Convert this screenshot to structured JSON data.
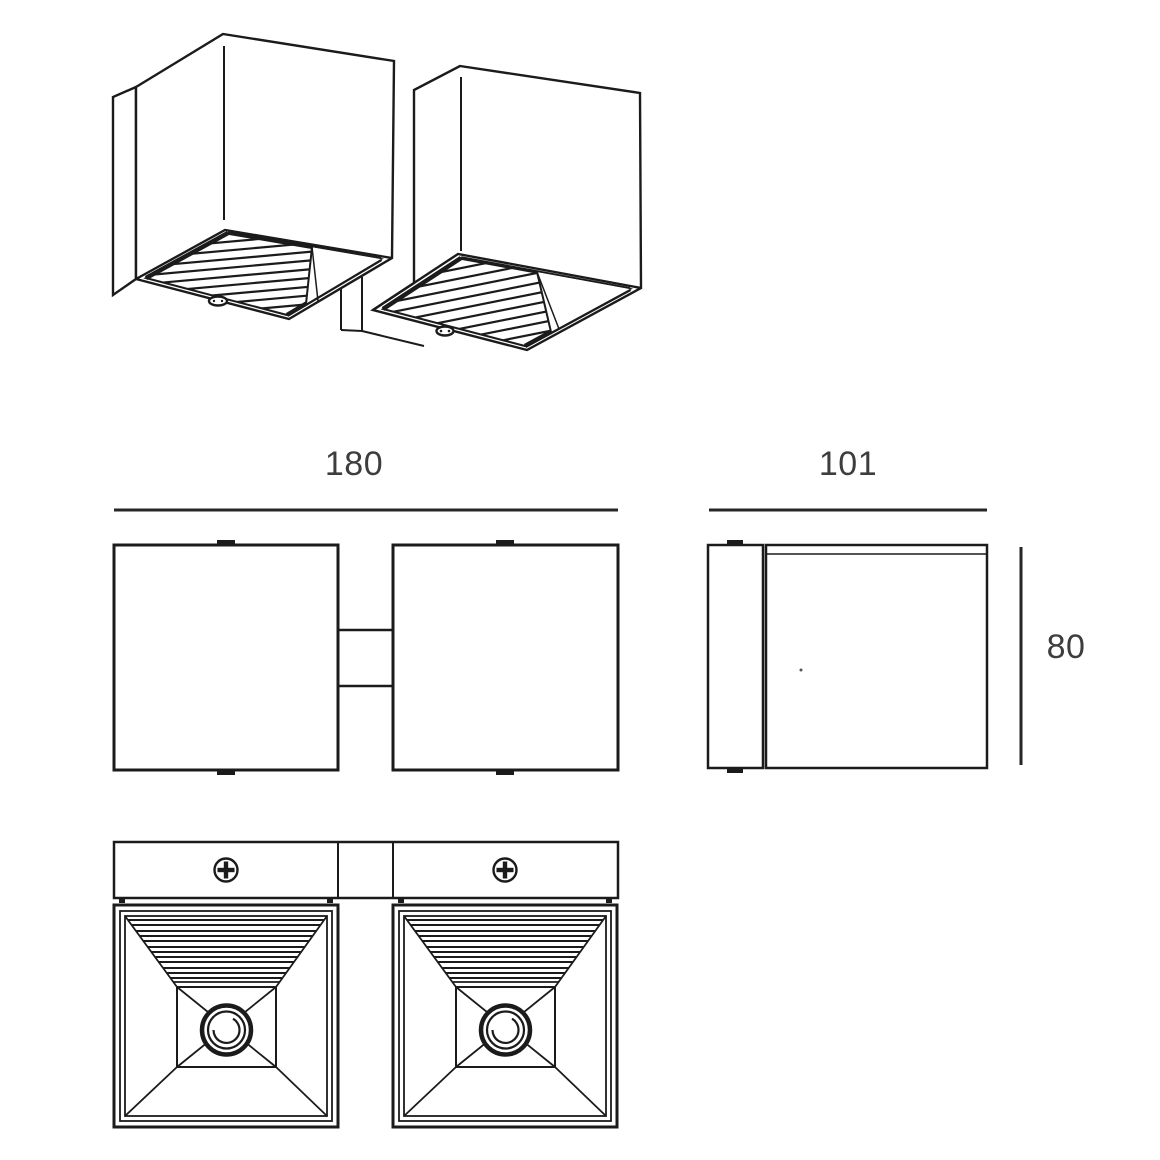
{
  "colors": {
    "background": "#ffffff",
    "line": "#1b1b1b",
    "dimension_text": "#3d3d3d"
  },
  "dimension_labels": {
    "total_width": "180",
    "depth": "101",
    "height": "80"
  },
  "bottom_view": {
    "screw_icon": "phillips-screw",
    "screw_count": 2
  }
}
